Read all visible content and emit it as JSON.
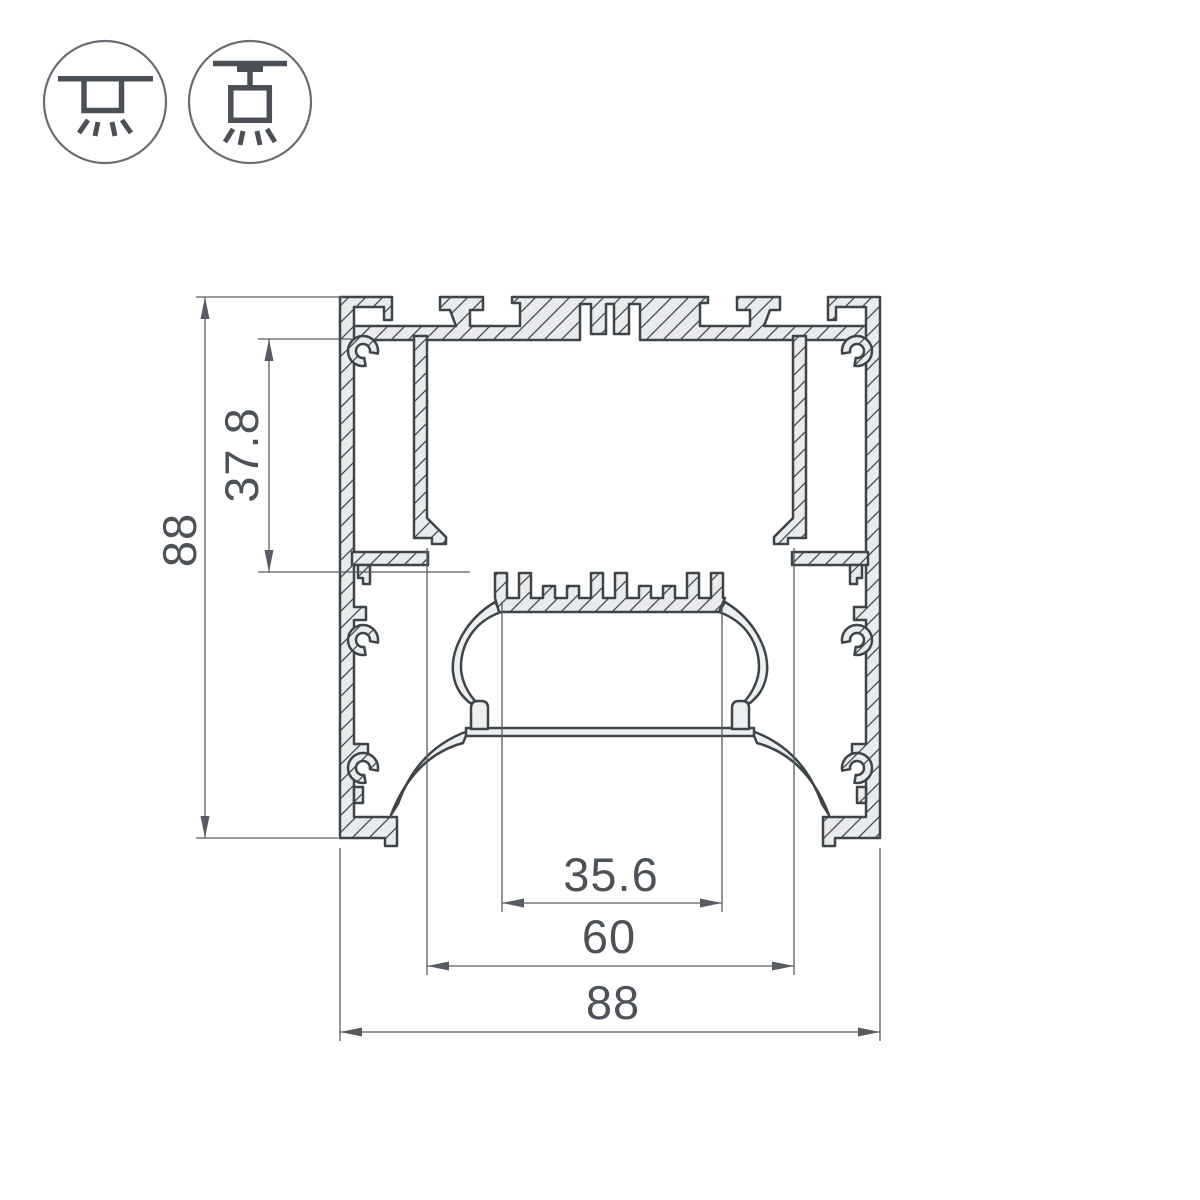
{
  "drawing": {
    "title": "aluminium-led-profile-cross-section",
    "colors": {
      "outline": "#3e4549",
      "material_fill": "#eaebed",
      "thin_wall_fill": "#edeff0",
      "dimension": "#565c61",
      "dimension_text": "#4c5257",
      "icon_stroke": "#4a5055",
      "icon_circle": "#676d72",
      "background": "#ffffff"
    },
    "dimensions": {
      "overall_height": "88",
      "box_depth": "37.8",
      "led_shelf_width": "35.6",
      "opening_width": "60",
      "overall_width": "88"
    },
    "icons": [
      {
        "name": "surface-mount-icon"
      },
      {
        "name": "pendant-mount-icon"
      }
    ]
  }
}
